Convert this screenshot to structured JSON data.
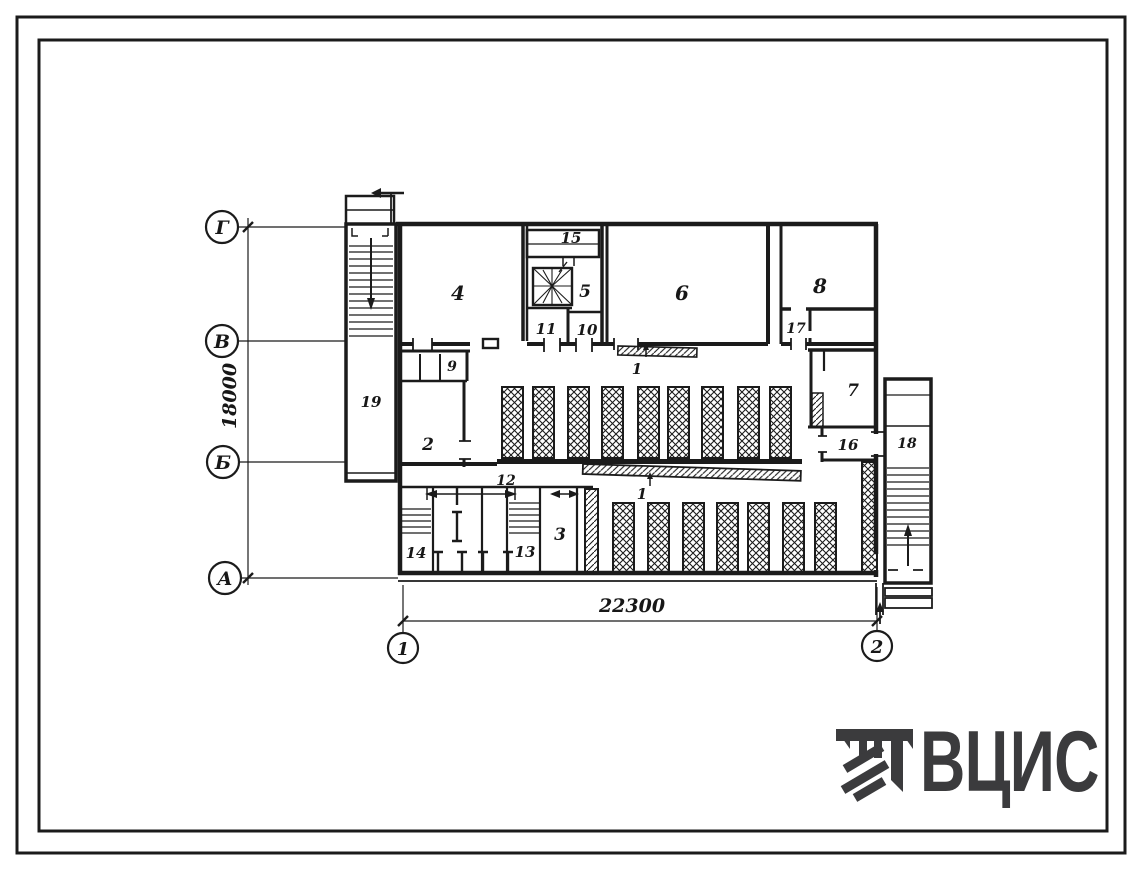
{
  "drawing_type": "floor-plan",
  "axes": {
    "rows": [
      {
        "label": "Г"
      },
      {
        "label": "В"
      },
      {
        "label": "Б"
      },
      {
        "label": "А"
      }
    ],
    "cols": [
      {
        "label": "1"
      },
      {
        "label": "2"
      }
    ]
  },
  "dimensions": {
    "vertical": "18000",
    "horizontal": "22300"
  },
  "rooms": {
    "r1": "1",
    "r2": "2",
    "r3": "3",
    "r4": "4",
    "r5": "5",
    "r6": "6",
    "r7": "7",
    "r8": "8",
    "r9": "9",
    "r10": "10",
    "r11": "11",
    "r12": "12",
    "r13": "13",
    "r14": "14",
    "r15": "15",
    "r16": "16",
    "r17": "17",
    "r18": "18",
    "r19": "19"
  },
  "logo": {
    "text": "ВЦИС"
  },
  "colors": {
    "line": "#1b1b1b",
    "logo": "#3b3b3d",
    "paper": "#ffffff"
  }
}
